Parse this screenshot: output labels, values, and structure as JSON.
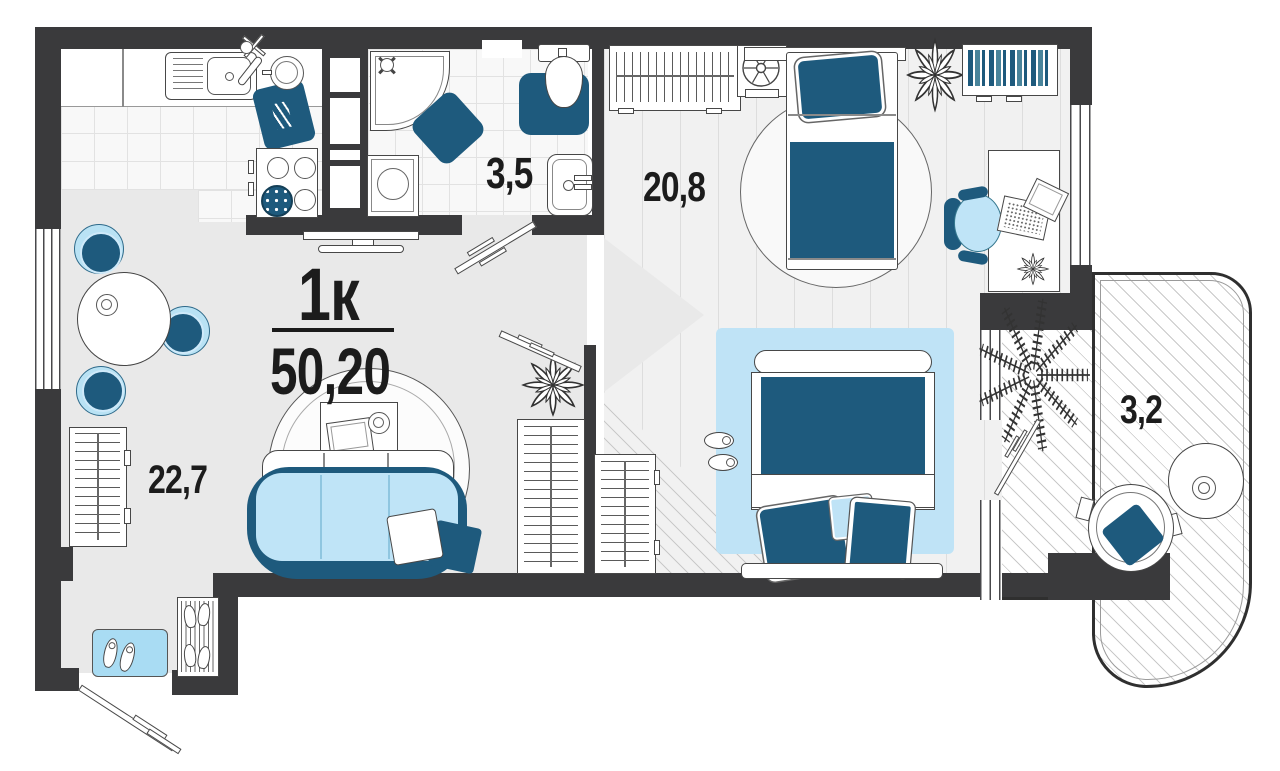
{
  "plan": {
    "title": "1к",
    "total_area": "50,20",
    "areas": {
      "living_kitchen": "22,7",
      "bathroom": "3,5",
      "bedroom": "20,8",
      "balcony": "3,2"
    },
    "colors": {
      "wall": "#3a3a3c",
      "accent_dark": "#1e5a7d",
      "accent_light": "#bfe4f7",
      "mat_blue": "#a9dcf3",
      "floor": "#e9e9e9",
      "text": "#1c1c1c"
    },
    "furniture_icons": [
      "kitchen-sink-icon",
      "faucet-icon",
      "cutting-board-icon",
      "pot-icon",
      "stove-icon",
      "pan-icon",
      "tv-icon",
      "dining-table",
      "dining-chair",
      "wardrobe",
      "sofa",
      "pillow",
      "round-rug",
      "coffee-table",
      "book-icon",
      "cup-icon",
      "entry-mat",
      "shoes-icon",
      "shoe-rack",
      "door-leaf",
      "shower",
      "shower-valve-icon",
      "bath-mat",
      "toilet",
      "washing-machine",
      "washbasin",
      "plant-icon",
      "fan-icon",
      "single-bed",
      "double-bed",
      "slippers-icon",
      "bookshelf",
      "desk",
      "laptop-icon",
      "office-chair",
      "balcony-armchair",
      "balcony-table",
      "palm-plant-icon",
      "window"
    ]
  }
}
